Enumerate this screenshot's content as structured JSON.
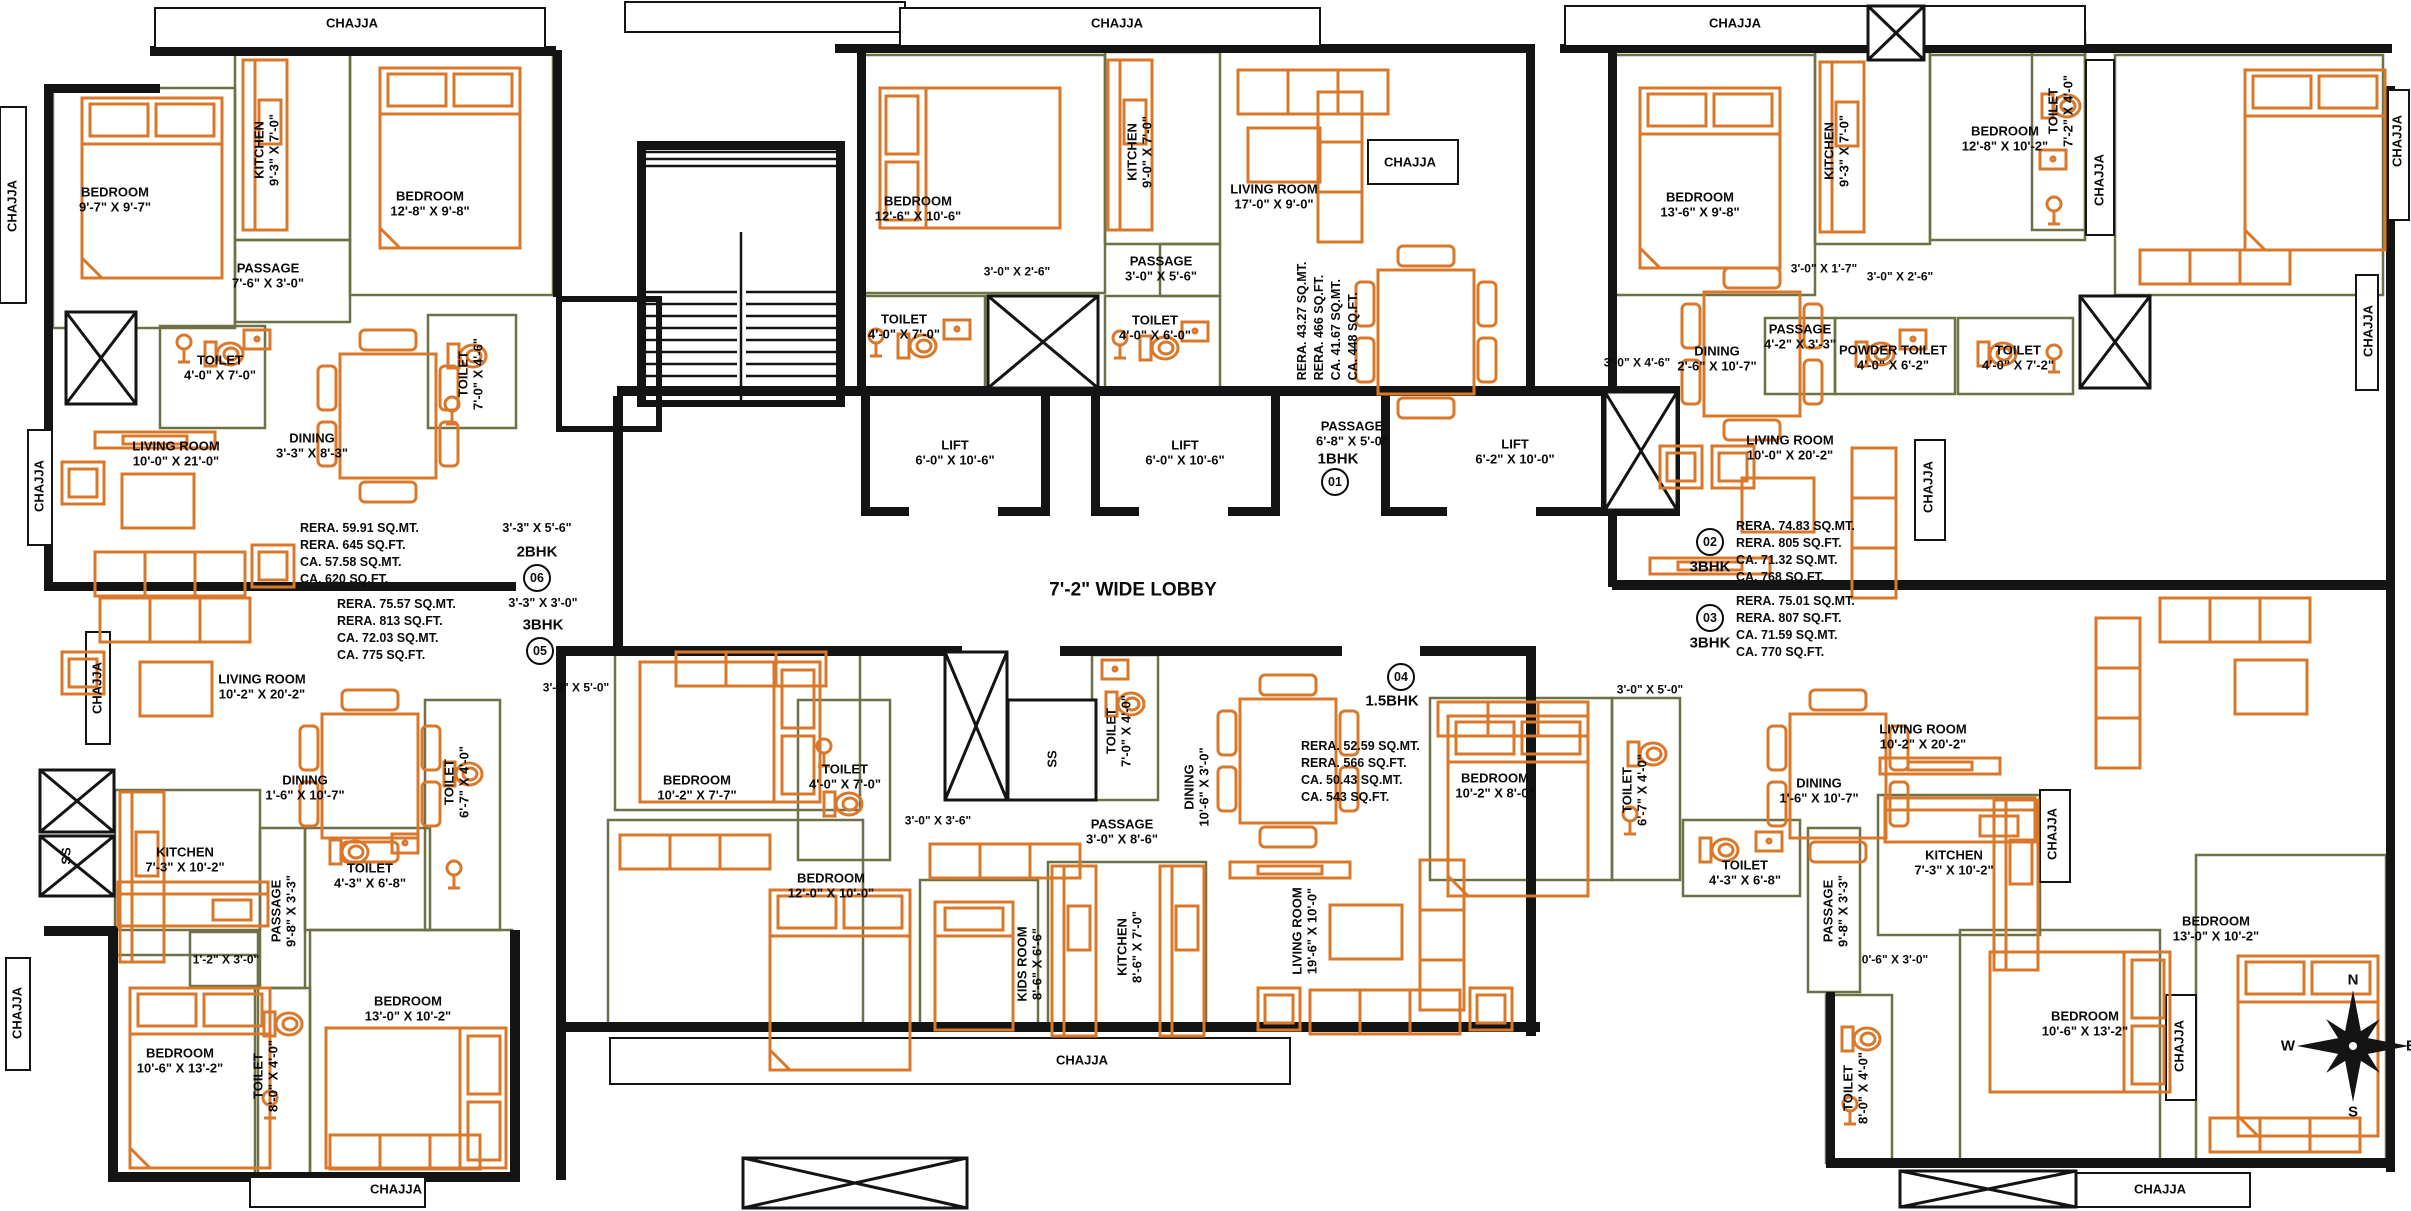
{
  "plan": {
    "title": "floor-plan",
    "lobby_label": "7'-2\" WIDE LOBBY",
    "colors": {
      "furniture": "#D9782A",
      "wall": "#141414",
      "partition": "#6E7045",
      "paper": "#ffffff"
    },
    "compass": {
      "n": "N",
      "s": "S",
      "e": "E",
      "w": "W"
    },
    "units": [
      {
        "no": "01",
        "type": "1BHK",
        "entry_dim": "",
        "areas": [
          "RERA. 43.27 SQ.MT.",
          "RERA. 466 SQ.FT.",
          "CA. 41.67 SQ.MT.",
          "CA. 448 SQ.FT."
        ],
        "pos": {
          "circle": {
            "x": 1335,
            "y": 482
          },
          "type": {
            "x": 1338,
            "y": 459
          },
          "dim": null,
          "areas": {
            "x": 1328,
            "y": 321,
            "rot": true
          }
        }
      },
      {
        "no": "02",
        "type": "3BHK",
        "entry_dim": "",
        "areas": [
          "RERA. 74.83 SQ.MT.",
          "RERA. 805 SQ.FT.",
          "CA. 71.32 SQ.MT.",
          "CA. 768 SQ.FT."
        ],
        "pos": {
          "circle": {
            "x": 1710,
            "y": 542
          },
          "type": {
            "x": 1710,
            "y": 567
          },
          "dim": null,
          "areas": {
            "x": 1736,
            "y": 518,
            "rot": false
          }
        }
      },
      {
        "no": "03",
        "type": "3BHK",
        "entry_dim": "",
        "areas": [
          "RERA. 75.01 SQ.MT.",
          "RERA. 807 SQ.FT.",
          "CA. 71.59 SQ.MT.",
          "CA. 770 SQ.FT."
        ],
        "pos": {
          "circle": {
            "x": 1710,
            "y": 618
          },
          "type": {
            "x": 1710,
            "y": 643
          },
          "dim": null,
          "areas": {
            "x": 1736,
            "y": 593,
            "rot": false
          }
        }
      },
      {
        "no": "04",
        "type": "1.5BHK",
        "entry_dim": "",
        "areas": [
          "RERA. 52.59 SQ.MT.",
          "RERA. 566 SQ.FT.",
          "CA. 50.43 SQ.MT.",
          "CA. 543 SQ.FT."
        ],
        "pos": {
          "circle": {
            "x": 1401,
            "y": 677
          },
          "type": {
            "x": 1392,
            "y": 701
          },
          "dim": null,
          "areas": {
            "x": 1301,
            "y": 738,
            "rot": false
          }
        }
      },
      {
        "no": "05",
        "type": "3BHK",
        "entry_dim": "3'-3\" X 3'-0\"",
        "areas": [
          "RERA. 75.57 SQ.MT.",
          "RERA. 813 SQ.FT.",
          "CA. 72.03 SQ.MT.",
          "CA. 775 SQ.FT."
        ],
        "pos": {
          "circle": {
            "x": 540,
            "y": 651
          },
          "type": {
            "x": 543,
            "y": 625
          },
          "dim": {
            "x": 543,
            "y": 603
          },
          "areas": {
            "x": 337,
            "y": 596,
            "rot": false
          }
        }
      },
      {
        "no": "06",
        "type": "2BHK",
        "entry_dim": "3'-3\" X 5'-6\"",
        "areas": [
          "RERA. 59.91 SQ.MT.",
          "RERA. 645 SQ.FT.",
          "CA. 57.58 SQ.MT.",
          "CA. 620 SQ.FT."
        ],
        "pos": {
          "circle": {
            "x": 537,
            "y": 578
          },
          "type": {
            "x": 537,
            "y": 552
          },
          "dim": {
            "x": 537,
            "y": 528
          },
          "areas": {
            "x": 300,
            "y": 520,
            "rot": false
          }
        }
      }
    ],
    "labels": [
      {
        "n": "chajja",
        "t": "CHAJJA",
        "x": 352,
        "y": 24
      },
      {
        "n": "chajja",
        "t": "CHAJJA",
        "x": 1117,
        "y": 24
      },
      {
        "n": "chajja",
        "t": "CHAJJA",
        "x": 1410,
        "y": 163
      },
      {
        "n": "chajja",
        "t": "CHAJJA",
        "x": 1735,
        "y": 24
      },
      {
        "n": "chajja",
        "t": "CHAJJA",
        "x": 13,
        "y": 206,
        "r": 1
      },
      {
        "n": "chajja",
        "t": "CHAJJA",
        "x": 40,
        "y": 486,
        "r": 1
      },
      {
        "n": "chajja",
        "t": "CHAJJA",
        "x": 98,
        "y": 688,
        "r": 1
      },
      {
        "n": "chajja",
        "t": "CHAJJA",
        "x": 18,
        "y": 1013,
        "r": 1
      },
      {
        "n": "chajja",
        "t": "CHAJJA",
        "x": 396,
        "y": 1190
      },
      {
        "n": "chajja",
        "t": "CHAJJA",
        "x": 1082,
        "y": 1061
      },
      {
        "n": "chajja",
        "t": "CHAJJA",
        "x": 2160,
        "y": 1190
      },
      {
        "n": "chajja",
        "t": "CHAJJA",
        "x": 2100,
        "y": 180,
        "r": 1
      },
      {
        "n": "chajja",
        "t": "CHAJJA",
        "x": 1929,
        "y": 487,
        "r": 1
      },
      {
        "n": "chajja",
        "t": "CHAJJA",
        "x": 2053,
        "y": 834,
        "r": 1
      },
      {
        "n": "chajja",
        "t": "CHAJJA",
        "x": 2180,
        "y": 1046,
        "r": 1
      },
      {
        "n": "chajja",
        "t": "CHAJJA",
        "x": 2398,
        "y": 141,
        "r": 1
      },
      {
        "n": "chajja",
        "t": "CHAJJA",
        "x": 2369,
        "y": 331,
        "r": 1
      },
      {
        "n": "room-bedroom",
        "t": "BEDROOM|9'-7\" X 9'-7\"",
        "x": 115,
        "y": 200
      },
      {
        "n": "room-kitchen",
        "t": "KITCHEN|9'-3\" X 7'-0\"",
        "x": 267,
        "y": 150,
        "r": 1
      },
      {
        "n": "room-bedroom",
        "t": "BEDROOM|12'-8\" X 9'-8\"",
        "x": 430,
        "y": 204
      },
      {
        "n": "room-passage",
        "t": "PASSAGE|7'-6\" X 3'-0\"",
        "x": 268,
        "y": 276
      },
      {
        "n": "room-toilet",
        "t": "TOILET|4'-0\" X 7'-0\"",
        "x": 220,
        "y": 368
      },
      {
        "n": "room-toilet",
        "t": "TOILET|7'-0\" X 4'-6\"",
        "x": 471,
        "y": 374,
        "r": 1
      },
      {
        "n": "room-dining",
        "t": "DINING|3'-3\" X 8'-3\"",
        "x": 312,
        "y": 446
      },
      {
        "n": "room-living",
        "t": "LIVING ROOM|10'-0\" X 21'-0\"",
        "x": 176,
        "y": 454
      },
      {
        "n": "room-living",
        "t": "LIVING ROOM|10'-2\" X 20'-2\"",
        "x": 262,
        "y": 687
      },
      {
        "n": "room-dining",
        "t": "DINING|1'-6\" X 10'-7\"",
        "x": 305,
        "y": 788
      },
      {
        "n": "room-kitchen",
        "t": "KITCHEN|7'-3\" X 10'-2\"",
        "x": 185,
        "y": 860
      },
      {
        "n": "shaft-ss",
        "t": "SS",
        "x": 67,
        "y": 856,
        "r": 1
      },
      {
        "n": "room-toilet",
        "t": "TOILET|6'-7\" X 4'-0\"",
        "x": 457,
        "y": 782,
        "r": 1
      },
      {
        "n": "room-toilet",
        "t": "TOILET|4'-3\" X 6'-8\"",
        "x": 370,
        "y": 876
      },
      {
        "n": "room-passage",
        "t": "PASSAGE|9'-8\" X 3'-3\"",
        "x": 284,
        "y": 911,
        "r": 1
      },
      {
        "n": "dim",
        "t": "1'-2\" X 3'-0\"",
        "x": 226,
        "y": 960,
        "s": 12
      },
      {
        "n": "room-bedroom",
        "t": "BEDROOM|10'-6\" X 13'-2\"",
        "x": 180,
        "y": 1061
      },
      {
        "n": "room-toilet",
        "t": "TOILET|8'-0\" X 4'-0\"",
        "x": 266,
        "y": 1076,
        "r": 1
      },
      {
        "n": "room-bedroom",
        "t": "BEDROOM|13'-0\" X 10'-2\"",
        "x": 408,
        "y": 1009
      },
      {
        "n": "room-bedroom",
        "t": "BEDROOM|12'-6\" X 10'-6\"",
        "x": 918,
        "y": 209
      },
      {
        "n": "room-kitchen",
        "t": "KITCHEN|9'-0\" X 7'-0\"",
        "x": 1140,
        "y": 152,
        "r": 1
      },
      {
        "n": "room-living",
        "t": "LIVING ROOM|17'-0\" X 9'-0\"",
        "x": 1274,
        "y": 197
      },
      {
        "n": "room-passage",
        "t": "PASSAGE|3'-0\" X 5'-6\"",
        "x": 1161,
        "y": 269
      },
      {
        "n": "room-toilet",
        "t": "TOILET|4'-0\" X 7'-0\"",
        "x": 904,
        "y": 327
      },
      {
        "n": "room-toilet",
        "t": "TOILET|4'-0\" X 6'-0\"",
        "x": 1155,
        "y": 328
      },
      {
        "n": "dim",
        "t": "3'-0\" X 2'-6\"",
        "x": 1017,
        "y": 272,
        "s": 12
      },
      {
        "n": "lift",
        "t": "LIFT|6'-0\" X 10'-6\"",
        "x": 955,
        "y": 453
      },
      {
        "n": "lift",
        "t": "LIFT|6'-0\" X 10'-6\"",
        "x": 1185,
        "y": 453
      },
      {
        "n": "lift",
        "t": "LIFT|6'-2\" X 10'-0\"",
        "x": 1515,
        "y": 452
      },
      {
        "n": "room-passage",
        "t": "PASSAGE|6'-8\" X 5'-0\"",
        "x": 1352,
        "y": 434
      },
      {
        "n": "shaft-ss",
        "t": "SS",
        "x": 1053,
        "y": 759,
        "r": 1
      },
      {
        "n": "room-toilet",
        "t": "TOILET|7'-0\" X 4'-0\"",
        "x": 1119,
        "y": 731,
        "r": 1
      },
      {
        "n": "room-dining",
        "t": "DINING|10'-6\" X 3'-0\"",
        "x": 1197,
        "y": 787,
        "r": 1
      },
      {
        "n": "room-passage",
        "t": "PASSAGE|3'-0\" X 8'-6\"",
        "x": 1122,
        "y": 832
      },
      {
        "n": "dim",
        "t": "3'-0\" X 3'-6\"",
        "x": 938,
        "y": 821,
        "s": 12
      },
      {
        "n": "room-bedroom",
        "t": "BEDROOM|12'-0\" X 10'-0\"",
        "x": 831,
        "y": 886
      },
      {
        "n": "room-kids",
        "t": "KIDS ROOM|8'-6\" X 6'-6\"",
        "x": 1030,
        "y": 964,
        "r": 1
      },
      {
        "n": "room-kitchen",
        "t": "KITCHEN|8'-6\" X 7'-0\"",
        "x": 1130,
        "y": 947,
        "r": 1
      },
      {
        "n": "room-living",
        "t": "LIVING ROOM|19'-6\" X 10'-0\"",
        "x": 1305,
        "y": 931,
        "r": 1
      },
      {
        "n": "dim",
        "t": "3'-0\" X 5'-0\"",
        "x": 576,
        "y": 688,
        "s": 12
      },
      {
        "n": "dim",
        "t": "3'-0\" X 5'-0\"",
        "x": 1650,
        "y": 690,
        "s": 12
      },
      {
        "n": "room-bedroom",
        "t": "BEDROOM|10'-2\" X 7'-7\"",
        "x": 697,
        "y": 788
      },
      {
        "n": "room-toilet",
        "t": "TOILET|4'-0\" X 7'-0\"",
        "x": 845,
        "y": 777
      },
      {
        "n": "room-bedroom",
        "t": "BEDROOM|13'-6\" X 9'-8\"",
        "x": 1700,
        "y": 205
      },
      {
        "n": "room-kitchen",
        "t": "KITCHEN|9'-3\" X 7'-0\"",
        "x": 1837,
        "y": 151,
        "r": 1
      },
      {
        "n": "room-bedroom",
        "t": "BEDROOM|12'-8\" X 10'-2\"",
        "x": 2005,
        "y": 139
      },
      {
        "n": "room-toilet",
        "t": "TOILET|7'-2\" X 4'-0\"",
        "x": 2061,
        "y": 111,
        "r": 1
      },
      {
        "n": "dim",
        "t": "3'-0\" X 1'-7\"",
        "x": 1824,
        "y": 269,
        "s": 12
      },
      {
        "n": "dim",
        "t": "3'-0\" X 2'-6\"",
        "x": 1900,
        "y": 277,
        "s": 12
      },
      {
        "n": "room-passage",
        "t": "PASSAGE|4'-2\" X 3'-3\"",
        "x": 1800,
        "y": 337
      },
      {
        "n": "room-toilet",
        "t": "POWDER TOILET|4'-0\" X 6'-2\"",
        "x": 1893,
        "y": 358
      },
      {
        "n": "room-toilet",
        "t": "TOILET|4'-0\" X 7'-2\"",
        "x": 2018,
        "y": 358
      },
      {
        "n": "room-dining",
        "t": "DINING|2'-6\" X 10'-7\"",
        "x": 1717,
        "y": 359
      },
      {
        "n": "dim",
        "t": "3'-0\" X 4'-6\"",
        "x": 1637,
        "y": 363,
        "s": 12
      },
      {
        "n": "room-living",
        "t": "LIVING ROOM|10'-0\" X 20'-2\"",
        "x": 1790,
        "y": 448
      },
      {
        "n": "room-bedroom",
        "t": "BEDROOM|10'-2\" X 8'-0\"",
        "x": 1495,
        "y": 786
      },
      {
        "n": "room-toilet",
        "t": "TOILET|6'-7\" X 4'-0\"",
        "x": 1635,
        "y": 790,
        "r": 1
      },
      {
        "n": "room-toilet",
        "t": "TOILET|4'-3\" X 6'-8\"",
        "x": 1745,
        "y": 873
      },
      {
        "n": "room-living",
        "t": "LIVING ROOM|10'-2\" X 20'-2\"",
        "x": 1923,
        "y": 737
      },
      {
        "n": "room-dining",
        "t": "DINING|1'-6\" X 10'-7\"",
        "x": 1819,
        "y": 791
      },
      {
        "n": "room-kitchen",
        "t": "KITCHEN|7'-3\" X 10'-2\"",
        "x": 1954,
        "y": 863
      },
      {
        "n": "room-passage",
        "t": "PASSAGE|9'-8\" X 3'-3\"",
        "x": 1836,
        "y": 911,
        "r": 1
      },
      {
        "n": "dim",
        "t": "0'-6\" X 3'-0\"",
        "x": 1895,
        "y": 960,
        "s": 12
      },
      {
        "n": "room-bedroom",
        "t": "BEDROOM|13'-0\" X 10'-2\"",
        "x": 2216,
        "y": 929
      },
      {
        "n": "room-bedroom",
        "t": "BEDROOM|10'-6\" X 13'-2\"",
        "x": 2085,
        "y": 1024
      },
      {
        "n": "room-toilet",
        "t": "TOILET|8'-0\" X 4'-0\"",
        "x": 1856,
        "y": 1088,
        "r": 1
      }
    ]
  }
}
